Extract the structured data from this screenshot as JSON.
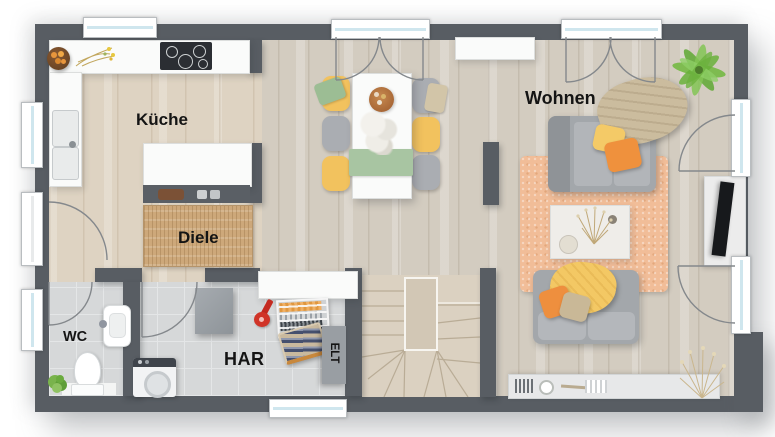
{
  "plan": {
    "type": "floor-plan",
    "rooms": {
      "kueche": {
        "label": "Küche"
      },
      "diele": {
        "label": "Diele"
      },
      "wohnen": {
        "label": "Wohnen"
      },
      "wc": {
        "label": "WC"
      },
      "har": {
        "label": "HAR"
      },
      "elt": {
        "label": "ELT"
      }
    },
    "colors": {
      "wall": "#585d63",
      "floor_wood_warm": "#ded3c2",
      "floor_wood_cool": "#d3ccc0",
      "floor_tile": "#d6d8d9",
      "stairs_wood": "#dbd1c1",
      "rug_jute": "#cda87a",
      "rug_peach": "#f1bd98",
      "accent_yellow": "#f2c25e",
      "accent_orange": "#ee8f3e",
      "accent_green": "#a8c5a2",
      "sofa_gray": "#a3a7ab",
      "plant_green": "#6db13f",
      "window_glass": "#cfe6ee",
      "label_text": "#141414"
    },
    "furniture_icons": [
      "cooktop-icon",
      "kitchen-sink-icon",
      "fruit-bowl-icon",
      "flower-decor-icon",
      "wardrobe-icon",
      "doormat-rug-icon",
      "dining-table-icon",
      "dining-chair-icon",
      "sideboard-icon",
      "sofa-icon",
      "coffee-table-icon",
      "tv-icon",
      "palm-plant-icon",
      "dried-plant-icon",
      "area-rug-icon",
      "toilet-icon",
      "washbasin-icon",
      "washing-machine-icon",
      "drying-rack-icon",
      "laundry-basket-icon",
      "vacuum-icon",
      "utility-cabinet-icon",
      "staircase-icon",
      "lowboard-icon"
    ]
  }
}
